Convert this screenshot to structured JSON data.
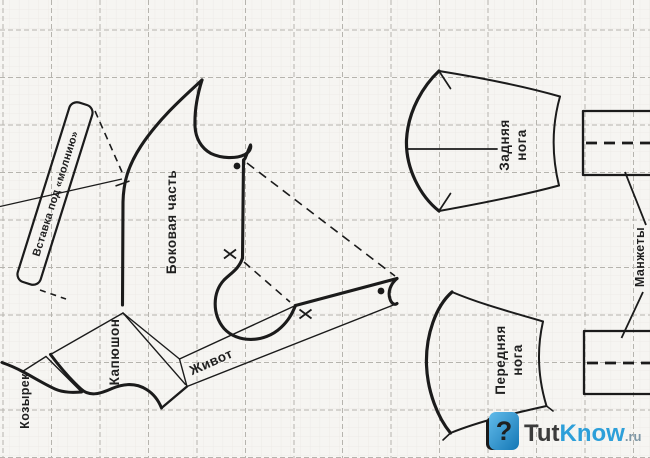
{
  "document": {
    "type": "sewing-pattern-scan",
    "subject": "dog overall pattern pieces on grid paper"
  },
  "colors": {
    "paper": "#f6f5f2",
    "line": "#1b1b1b",
    "grid_major": "#b6b4ae",
    "grid_minor": "#ebe9e5",
    "brand_blue": "#2d9fd9",
    "brand_dark": "#3b3b3b",
    "brand_ru": "#7e97a6"
  },
  "pieces": {
    "zipper_insert": {
      "label": "Вставка под «молнию»"
    },
    "side_part": {
      "label": "Боковая часть"
    },
    "hood": {
      "label": "Капюшон"
    },
    "belly": {
      "label": "Живот"
    },
    "visor": {
      "label": "Козырек"
    },
    "back_leg": {
      "label_lines": [
        "Задняя",
        "нога"
      ]
    },
    "front_leg": {
      "label_lines": [
        "Передняя",
        "нога"
      ]
    },
    "cuffs": {
      "label": "Манжеты"
    }
  },
  "watermark": {
    "icon": "question-mark-icon",
    "prefix": "Tut",
    "suffix": "Know",
    "tld": ".ru"
  }
}
